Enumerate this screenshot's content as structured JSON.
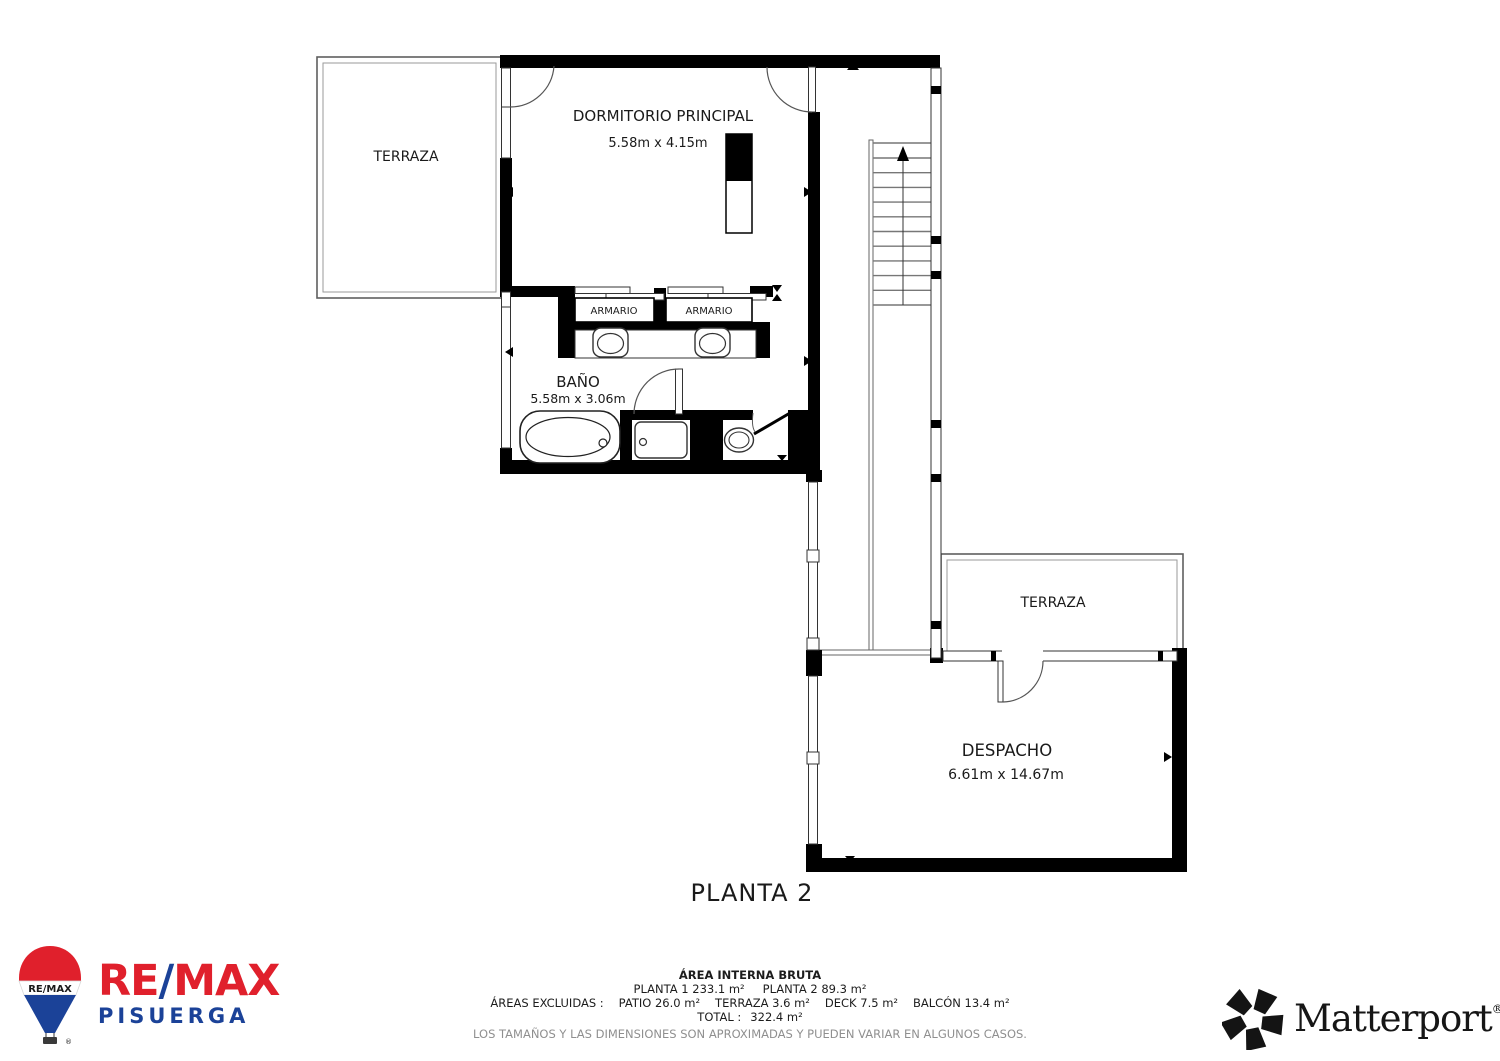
{
  "plan": {
    "title": "PLANTA 2",
    "rooms": {
      "terraza_top": {
        "name": "TERRAZA"
      },
      "dormitorio": {
        "name": "DORMITORIO PRINCIPAL",
        "dims": "5.58m x 4.15m"
      },
      "armario_left": {
        "name": "ARMARIO"
      },
      "armario_right": {
        "name": "ARMARIO"
      },
      "bano": {
        "name": "BAÑO",
        "dims": "5.58m x 3.06m"
      },
      "terraza_right": {
        "name": "TERRAZA"
      },
      "despacho": {
        "name": "DESPACHO",
        "dims": "6.61m x 14.67m"
      }
    }
  },
  "footer": {
    "area_title": "ÁREA INTERNA BRUTA",
    "plantas": [
      "PLANTA 1 233.1 m²",
      "PLANTA 2 89.3 m²"
    ],
    "excluidas_label": "ÁREAS EXCLUIDAS :",
    "excluidas": [
      "PATIO 26.0 m²",
      "TERRAZA 3.6 m²",
      "DECK 7.5 m²",
      "BALCÓN 13.4 m²"
    ],
    "total_label": "TOTAL :",
    "total_value": "322.4 m²",
    "disclaimer": "LOS TAMAÑOS Y LAS DIMENSIONES SON APROXIMADAS Y PUEDEN VARIAR EN ALGUNOS CASOS."
  },
  "branding": {
    "remax": {
      "word_re": "RE",
      "word_slash": "/",
      "word_max": "MAX",
      "subtitle": "PISUERGA",
      "balloon_label": "RE/MAX",
      "red": "#E0202C",
      "blue": "#1B4298"
    },
    "matterport": {
      "name": "Matterport",
      "reg": "®"
    }
  },
  "colors": {
    "wall": "#000000",
    "background": "#ffffff"
  }
}
